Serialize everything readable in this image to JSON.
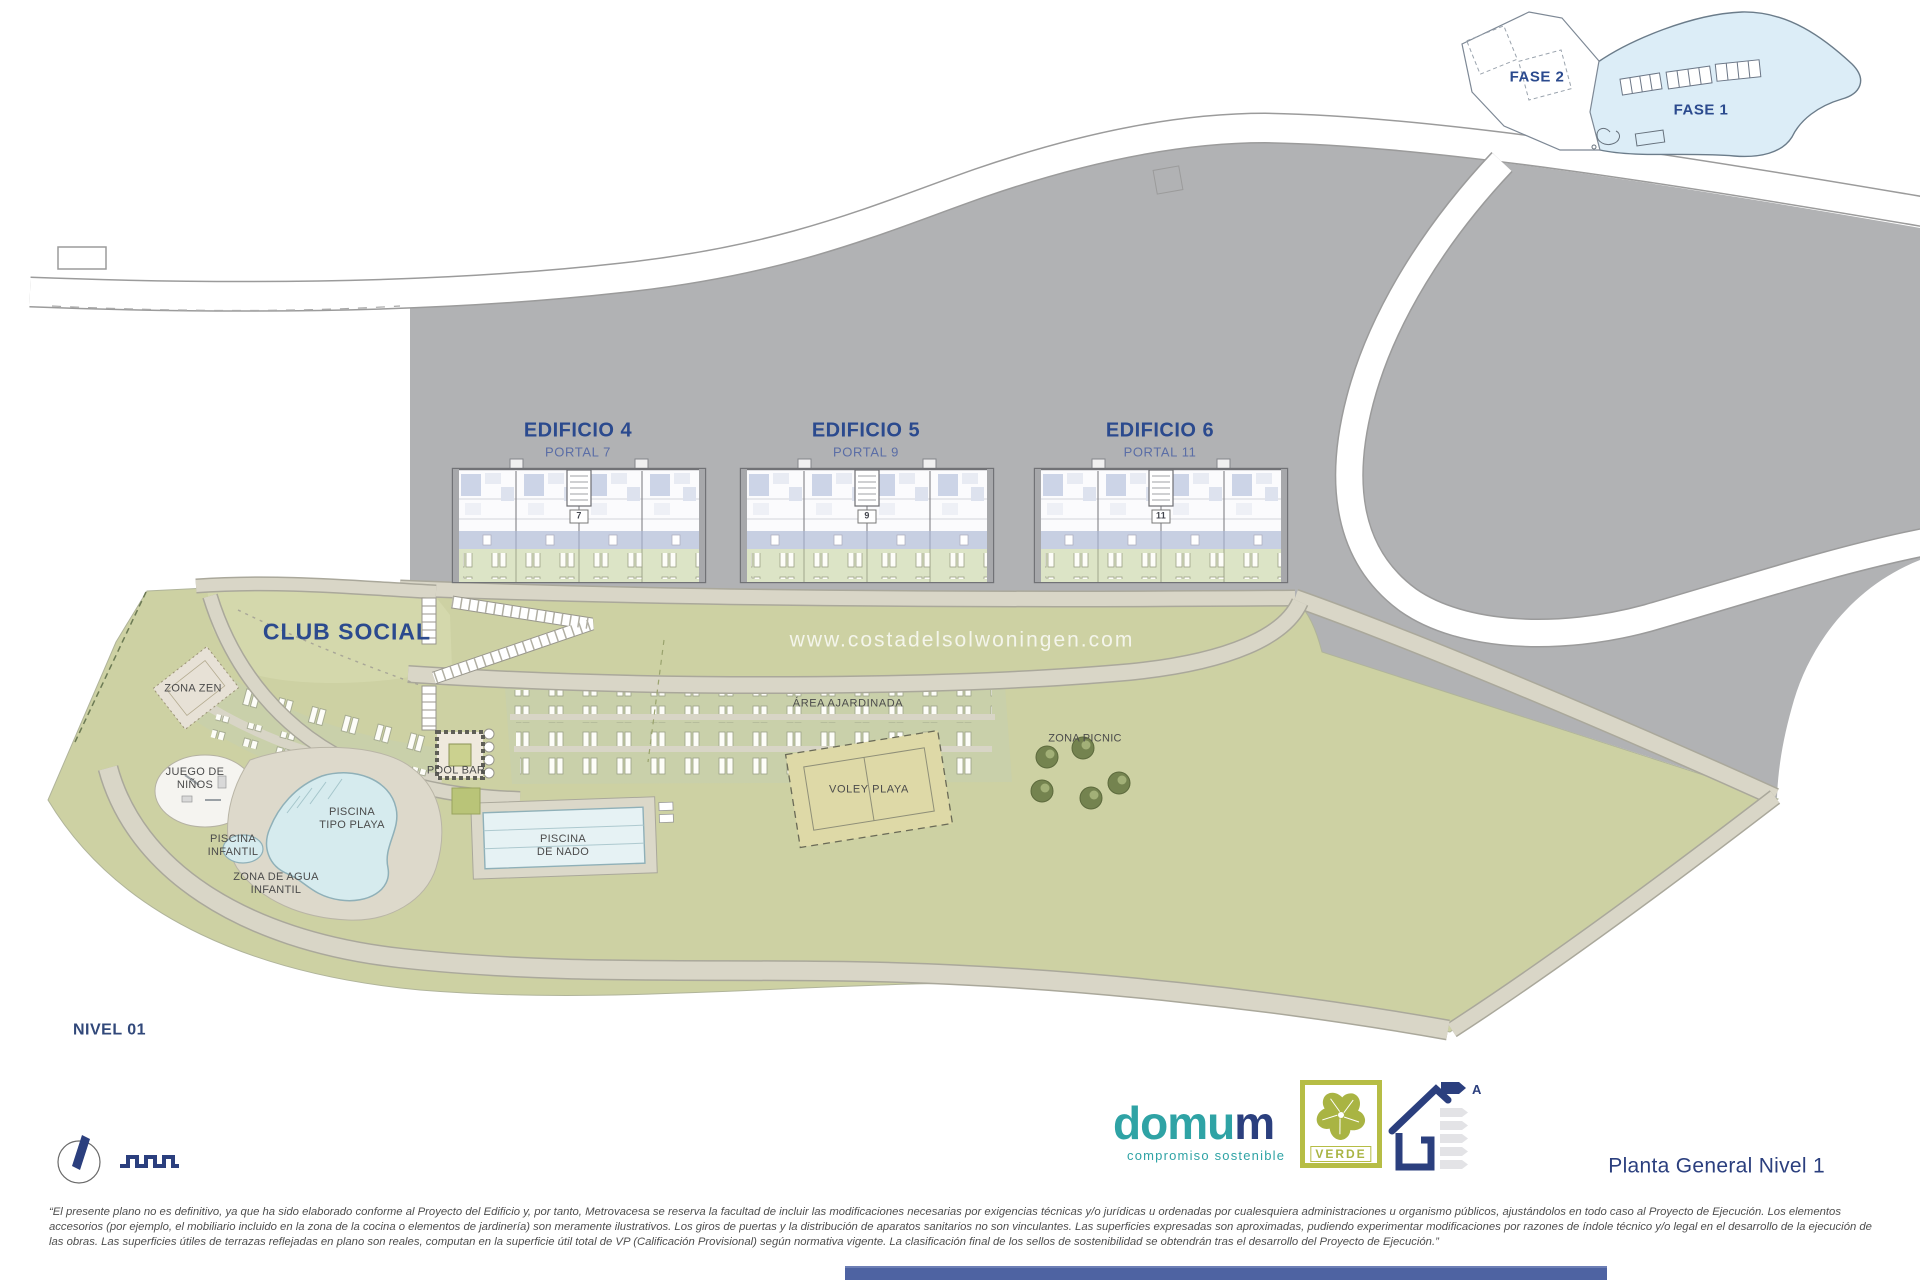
{
  "colors": {
    "navy_title": "#2b4a8e",
    "navy_logo": "#2b3f7e",
    "teal": "#2fa3a5",
    "olive": "#b6bd45",
    "hill_gray": "#b1b2b4",
    "lawn_green": "#cdd1a3",
    "path_beige": "#d9d6c7",
    "pool_blue": "#d6ebee",
    "fase1_blue": "#dcedf7",
    "footer_bar": "#4e63a2"
  },
  "inset": {
    "fase_2": "FASE 2",
    "fase_1": "FASE 1"
  },
  "plan": {
    "buildings": [
      {
        "title": "EDIFICIO 4",
        "portal": "PORTAL 7",
        "plate": "7"
      },
      {
        "title": "EDIFICIO 5",
        "portal": "PORTAL 9",
        "plate": "9"
      },
      {
        "title": "EDIFICIO 6",
        "portal": "PORTAL 11",
        "plate": "11"
      }
    ],
    "club_social": "CLUB SOCIAL",
    "labels": {
      "zona_zen": "ZONA ZEN",
      "juego_ninos": [
        "JUEGO DE",
        "NIÑOS"
      ],
      "piscina_infantil": [
        "PISCINA",
        "INFANTIL"
      ],
      "zona_agua_infantil": [
        "ZONA DE AGUA",
        "INFANTIL"
      ],
      "piscina_tipo_playa": [
        "PISCINA",
        "TIPO PLAYA"
      ],
      "pool_bar": "POOL BAR",
      "piscina_de_nado": [
        "PISCINA",
        "DE NADO"
      ],
      "area_ajardinada": "ÁREA AJARDINADA",
      "voley_playa": "VOLEY PLAYA",
      "zona_picnic": "ZONA PICNIC"
    },
    "watermark": "www.costadelsolwoningen.com",
    "level": "NIVEL 01"
  },
  "footer": {
    "brand_main": "domu",
    "brand_m": "m",
    "brand_tagline": "compromiso sostenible",
    "badge_label": "VERDE",
    "energy_class": "A",
    "sheet_title": "Planta General Nivel 1",
    "disclaimer": [
      "“El presente plano no es definitivo, ya que ha sido elaborado conforme al Proyecto del Edificio y, por tanto, Metrovacesa se reserva la facultad de incluir las modificaciones necesarias por exigencias técnicas y/o jurídicas u ordenadas por cualesquiera administraciones u organismo públicos, ajustándolos en todo caso al Proyecto de Ejecución. Los elementos",
      "accesorios (por ejemplo, el mobiliario incluido en la zona de la cocina o elementos de jardinería) son meramente ilustrativos. Los giros de puertas y la distribución de aparatos sanitarios no son vinculantes. Las superficies expresadas son aproximadas, pudiendo experimentar modificaciones por razones de índole técnico y/o legal en el desarrollo de la ejecución de",
      "las obras. Las superficies útiles de terrazas reflejadas en plano son reales, computan en la superficie útil total de VP (Calificación Provisional) según normativa vigente. La clasificación final de los sellos de sostenibilidad se obtendrán tras el desarrollo del Proyecto de Ejecución.”"
    ]
  }
}
